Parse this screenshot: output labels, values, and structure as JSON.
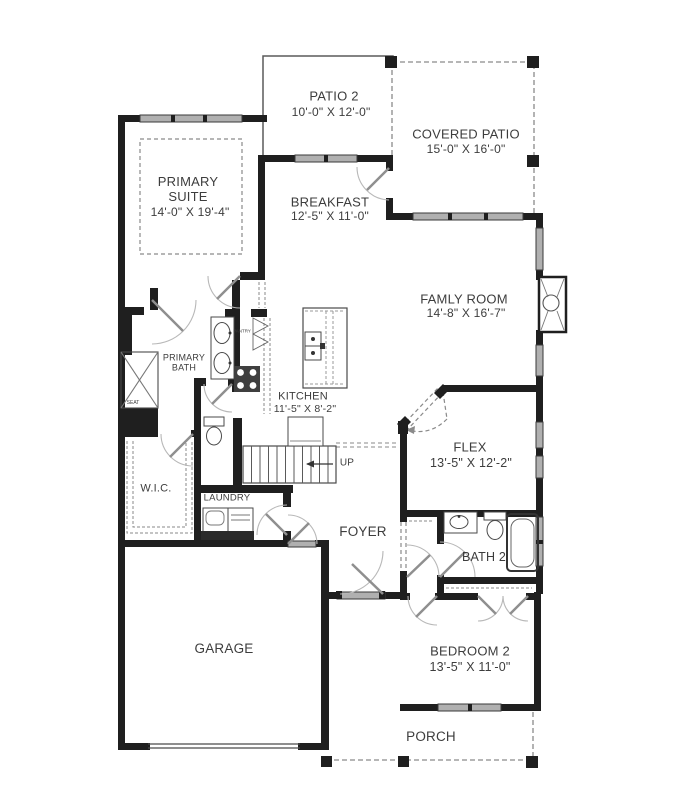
{
  "plan": {
    "background": "#ffffff",
    "wall_color": "#1f1f1f",
    "window_color": "#b0b0b0",
    "text_color": "#3d3d3d",
    "rooms": [
      {
        "id": "patio-2",
        "name": "PATIO 2",
        "dims": "10'-0\" X 12'-0\""
      },
      {
        "id": "covered-patio",
        "name": "COVERED PATIO",
        "dims": "15'-0\" X 16'-0\""
      },
      {
        "id": "primary-suite",
        "name": "PRIMARY SUITE",
        "dims": "14'-0\" X 19'-4\""
      },
      {
        "id": "breakfast",
        "name": "BREAKFAST",
        "dims": "12'-5\" X 11'-0\""
      },
      {
        "id": "family-room",
        "name": "FAMLY ROOM",
        "dims": "14'-8\" X 16'-7\""
      },
      {
        "id": "kitchen",
        "name": "KITCHEN",
        "dims": "11'-5\" X 8'-2\""
      },
      {
        "id": "flex",
        "name": "FLEX",
        "dims": "13'-5\" X 12'-2\""
      },
      {
        "id": "primary-bath",
        "name": "PRIMARY BATH"
      },
      {
        "id": "wic",
        "name": "W.I.C."
      },
      {
        "id": "laundry",
        "name": "LAUNDRY"
      },
      {
        "id": "foyer",
        "name": "FOYER"
      },
      {
        "id": "bath-2",
        "name": "BATH 2"
      },
      {
        "id": "garage",
        "name": "GARAGE"
      },
      {
        "id": "bedroom-2",
        "name": "BEDROOM 2",
        "dims": "13'-5\" X 11'-0\""
      },
      {
        "id": "porch",
        "name": "PORCH"
      }
    ],
    "annotations": {
      "up": "UP",
      "seat": "SEAT",
      "pantry": "PANTRY"
    }
  }
}
